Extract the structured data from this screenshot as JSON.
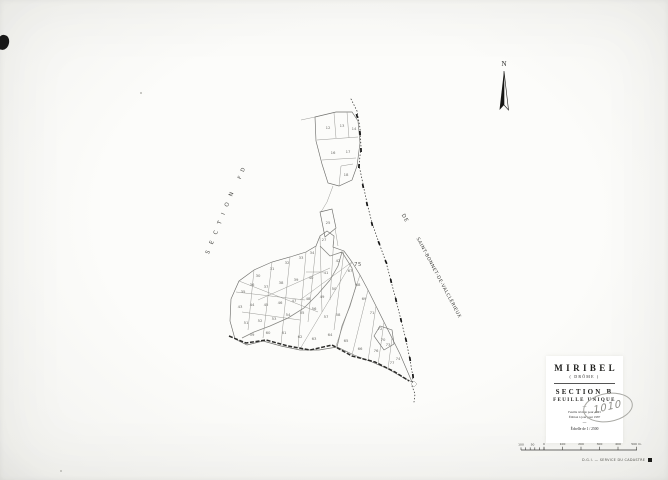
{
  "north_arrow": {
    "label": "N"
  },
  "adjacent_labels": {
    "left_section": "S E C T I O N",
    "left_section_suffix": "F D",
    "right_de": "DE",
    "right_commune": "SAINT-BONNET-DE-VALCLÉRIEUX"
  },
  "title_block": {
    "commune": "MIRIBEL",
    "department": "( DRÔME )",
    "section": "SECTION B",
    "sheet": "FEUILLE UNIQUE",
    "revision_line1": "Feuille révisée pour 1943",
    "revision_line2": "Édition à jour pour 1987",
    "scale_line": "Échelle de 1 / 2500"
  },
  "annotations": {
    "handwritten_number": "1010"
  },
  "footer": {
    "print_line": "D.G.I. — SERVICE DU CADASTRE",
    "mark_color": "#1c1c1a"
  },
  "scale_bar": {
    "minor_labels": [
      "100",
      "50"
    ],
    "major_labels": [
      "0",
      "100",
      "200",
      "300",
      "400",
      "500 m."
    ]
  },
  "map": {
    "layers": [
      {
        "cls": "thin",
        "d": "M301,120 L315,117"
      },
      {
        "cls": "outline",
        "d": "M315,117 L336,112 L352,112 L358,121 L360,143 L357,166 L352,180 L339,186 L328,183 L322,164 L316,141 Z"
      },
      {
        "cls": "thin",
        "d": "M317,140 L358,137"
      },
      {
        "cls": "thin",
        "d": "M334,113 L336,138"
      },
      {
        "cls": "thin",
        "d": "M347,112 L349,138"
      },
      {
        "cls": "thin",
        "d": "M322,160 L356,158"
      },
      {
        "cls": "thin",
        "d": "M339,186 L341,166 L353,164"
      },
      {
        "cls": "thin",
        "d": "M333,186 L327,202 L321,212"
      },
      {
        "cls": "outline",
        "d": "M320,212 L332,209 L336,228 L325,237 Z"
      },
      {
        "cls": "thin",
        "d": "M335,228 L338,246"
      },
      {
        "cls": "outline",
        "d": "M231,299 L239,281 L254,270 L272,262 L290,257 L306,252 L316,246 L320,236 L327,231 L334,236 L333,247 L344,251 L352,262 L360,275 L368,290 L376,306 L384,322 L392,338 L400,354 L406,368 L412,382 L402,377 L388,369 L372,362 L354,355 L337,347 L319,350 L300,350 L281,346 L263,341 L247,345 L235,339 L230,321 Z"
      },
      {
        "cls": "thin",
        "d": "M239,281 L318,312"
      },
      {
        "cls": "thin",
        "d": "M254,270 L248,330"
      },
      {
        "cls": "thin",
        "d": "M272,262 L263,338"
      },
      {
        "cls": "thin",
        "d": "M290,257 L281,344"
      },
      {
        "cls": "thin",
        "d": "M306,252 L298,348"
      },
      {
        "cls": "thin",
        "d": "M316,246 L308,322"
      },
      {
        "cls": "thin",
        "d": "M236,292 L305,300"
      },
      {
        "cls": "thin",
        "d": "M242,312 L300,320"
      },
      {
        "cls": "thin",
        "d": "M258,300 L330,268"
      },
      {
        "cls": "thin",
        "d": "M320,236 L322,312"
      },
      {
        "cls": "thin",
        "d": "M334,236 L330,300"
      },
      {
        "cls": "thin",
        "d": "M344,251 L334,330"
      },
      {
        "cls": "thin",
        "d": "M352,262 L300,349"
      },
      {
        "cls": "thin",
        "d": "M360,275 L336,346"
      },
      {
        "cls": "thin",
        "d": "M368,290 L352,355"
      },
      {
        "cls": "thin",
        "d": "M376,306 L368,361"
      },
      {
        "cls": "thin",
        "d": "M384,322 L378,365"
      },
      {
        "cls": "thin",
        "d": "M392,338 L388,369"
      },
      {
        "cls": "thin",
        "d": "M300,300 L352,262"
      },
      {
        "cls": "outline",
        "d": "M374,336 L380,326 L392,330 L394,344 L384,350 Z"
      },
      {
        "cls": "road",
        "d": "M229,336 L246,343 L266,340 L288,346 L310,350 L332,345 L352,356 L375,362 L395,372 L409,381"
      },
      {
        "cls": "thin2",
        "d": "M320,246 L330,256 L342,252 L338,266 L330,280 L318,294 L304,308 L288,318 L270,326 L254,332 L242,338"
      },
      {
        "cls": "thin2",
        "d": "M342,252 L352,268 L356,286 L350,306 L342,326 L337,347"
      },
      {
        "cls": "bnd",
        "d": "M351,99 L357,111 L360,128 L361,147 L359,165 L363,184 L367,203 L372,223 L379,243 L386,262 L391,281 L396,300 L401,320 L406,340 L410,360 L413,377 L412,384"
      },
      {
        "cls": "bnd",
        "d": "M412,386 L415,394 L414,402"
      },
      {
        "cls": "thin",
        "d": "M411,384 l3,-3 l3,3 l-3,3 Z"
      },
      {
        "cls": "thin",
        "d": "M306,272 L324,272"
      }
    ],
    "boundary_ticks": [
      [
        357,
        116,
        72
      ],
      [
        360,
        133,
        83
      ],
      [
        361,
        150,
        88
      ],
      [
        359,
        166,
        95
      ],
      [
        363,
        186,
        78
      ],
      [
        367,
        204,
        78
      ],
      [
        372,
        224,
        76
      ],
      [
        379,
        243,
        68
      ],
      [
        386,
        262,
        66
      ],
      [
        391,
        281,
        78
      ],
      [
        396,
        300,
        78
      ],
      [
        401,
        320,
        78
      ],
      [
        406,
        340,
        76
      ],
      [
        410,
        359,
        80
      ],
      [
        413,
        376,
        84
      ]
    ],
    "parcel_numbers": [
      [
        328,
        129,
        "12"
      ],
      [
        342,
        127,
        "13"
      ],
      [
        354,
        130,
        "14"
      ],
      [
        333,
        154,
        "16"
      ],
      [
        348,
        153,
        "17"
      ],
      [
        346,
        176,
        "18"
      ],
      [
        328,
        224,
        "25"
      ],
      [
        324,
        241,
        "27"
      ],
      [
        258,
        277,
        "30"
      ],
      [
        272,
        270,
        "31"
      ],
      [
        287,
        264,
        "32"
      ],
      [
        301,
        259,
        "33"
      ],
      [
        312,
        254,
        "34"
      ],
      [
        243,
        293,
        "35"
      ],
      [
        252,
        286,
        "36"
      ],
      [
        266,
        288,
        "37"
      ],
      [
        281,
        284,
        "38"
      ],
      [
        296,
        281,
        "39"
      ],
      [
        311,
        279,
        "40"
      ],
      [
        326,
        274,
        "41"
      ],
      [
        338,
        262,
        "42"
      ],
      [
        240,
        308,
        "43"
      ],
      [
        252,
        306,
        "44"
      ],
      [
        266,
        306,
        "45"
      ],
      [
        280,
        304,
        "46"
      ],
      [
        294,
        302,
        "47"
      ],
      [
        308,
        300,
        "48"
      ],
      [
        322,
        298,
        "49"
      ],
      [
        334,
        290,
        "50"
      ],
      [
        246,
        324,
        "51"
      ],
      [
        260,
        322,
        "52"
      ],
      [
        274,
        320,
        "53"
      ],
      [
        288,
        316,
        "54"
      ],
      [
        302,
        314,
        "55"
      ],
      [
        314,
        310,
        "56"
      ],
      [
        326,
        318,
        "57"
      ],
      [
        338,
        316,
        "58"
      ],
      [
        252,
        336,
        "59"
      ],
      [
        268,
        334,
        "60"
      ],
      [
        284,
        334,
        "61"
      ],
      [
        300,
        338,
        "62"
      ],
      [
        314,
        340,
        "63"
      ],
      [
        330,
        336,
        "64"
      ],
      [
        346,
        342,
        "65"
      ],
      [
        360,
        350,
        "66"
      ],
      [
        350,
        272,
        "67"
      ],
      [
        358,
        286,
        "68"
      ],
      [
        364,
        300,
        "69"
      ],
      [
        372,
        314,
        "71"
      ],
      [
        380,
        330,
        "72"
      ],
      [
        388,
        346,
        "73"
      ],
      [
        398,
        360,
        "74"
      ],
      [
        376,
        352,
        "76"
      ],
      [
        392,
        364,
        "77"
      ],
      [
        383,
        341,
        "70"
      ],
      [
        358,
        266,
        "75",
        1
      ]
    ]
  }
}
